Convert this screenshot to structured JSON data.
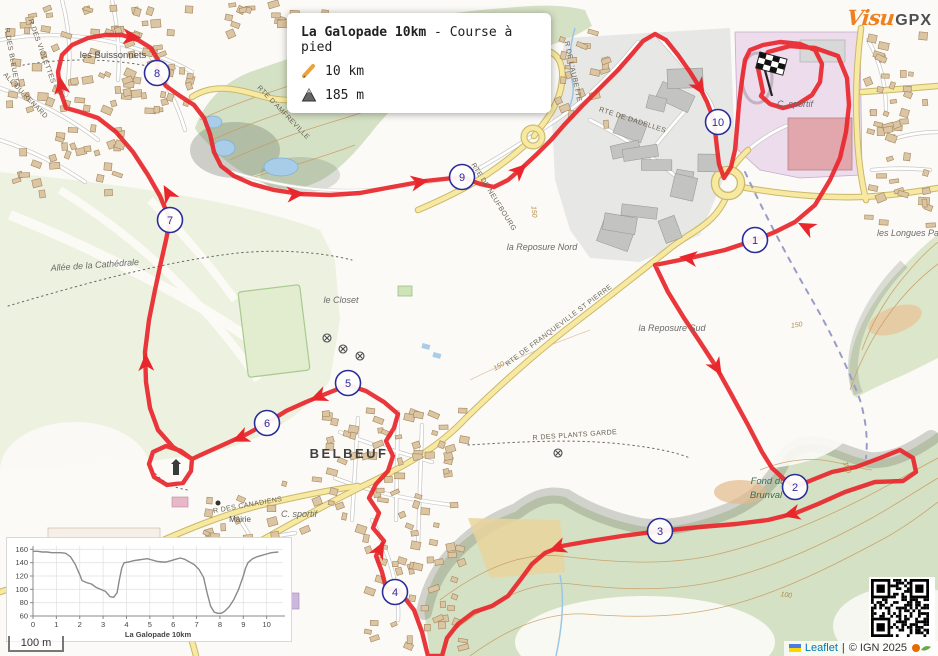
{
  "info_box": {
    "title_bold": "La Galopade 10km",
    "title_sep": " - ",
    "title_rest": "Course à pied",
    "distance": "10 km",
    "elevation_gain": "185 m"
  },
  "brand": {
    "visu": "Visu",
    "gpx": "GPX"
  },
  "scale_bar": {
    "label": "100 m"
  },
  "attribution": {
    "leaflet": "Leaflet",
    "separator": "|",
    "ign": "© IGN 2025"
  },
  "colors": {
    "route": "#e8262b",
    "marker_border": "#2d2d99",
    "forest": "#d5e1c4",
    "road_main": "#f8e9a2",
    "water": "#a8cde8",
    "brand_orange": "#f07f1e"
  },
  "map": {
    "km_markers": [
      {
        "label": "1",
        "x": 755,
        "y": 240
      },
      {
        "label": "2",
        "x": 795,
        "y": 487
      },
      {
        "label": "3",
        "x": 660,
        "y": 531
      },
      {
        "label": "4",
        "x": 395,
        "y": 592
      },
      {
        "label": "5",
        "x": 348,
        "y": 383
      },
      {
        "label": "6",
        "x": 267,
        "y": 423
      },
      {
        "label": "7",
        "x": 170,
        "y": 220
      },
      {
        "label": "8",
        "x": 157,
        "y": 73
      },
      {
        "label": "9",
        "x": 462,
        "y": 177
      },
      {
        "label": "10",
        "x": 718,
        "y": 122
      }
    ],
    "labels": [
      {
        "t": "les Buissonnets",
        "x": 113,
        "y": 58,
        "r": 0,
        "c": "place"
      },
      {
        "t": "BELBEUF",
        "x": 349,
        "y": 458,
        "r": 0,
        "c": "town"
      },
      {
        "t": "le Closet",
        "x": 341,
        "y": 303,
        "r": 0,
        "c": "place-i"
      },
      {
        "t": "la Reposure Nord",
        "x": 542,
        "y": 250,
        "r": 0,
        "c": "place-i"
      },
      {
        "t": "la Reposure Sud",
        "x": 672,
        "y": 331,
        "r": 0,
        "c": "place-i"
      },
      {
        "t": "Allée de la Cathédrale",
        "x": 95,
        "y": 268,
        "r": -4,
        "c": "place-i"
      },
      {
        "t": "les Longues Pa",
        "x": 908,
        "y": 236,
        "r": 0,
        "c": "place-i"
      },
      {
        "t": "Fond du",
        "x": 768,
        "y": 484,
        "r": 0,
        "c": "nature"
      },
      {
        "t": "Brunval",
        "x": 766,
        "y": 498,
        "r": 0,
        "c": "nature"
      },
      {
        "t": "C. sportif",
        "x": 795,
        "y": 107,
        "r": 0,
        "c": "place-i"
      },
      {
        "t": "C. sportif",
        "x": 299,
        "y": 517,
        "r": 0,
        "c": "place-i"
      },
      {
        "t": "Mairie",
        "x": 240,
        "y": 522,
        "r": 0,
        "c": "place-s"
      },
      {
        "t": "RTE DE FRANQUEVILLE ST PIERRE",
        "x": 560,
        "y": 327,
        "r": -37,
        "c": "road"
      },
      {
        "t": "RTE DE DADELLES",
        "x": 632,
        "y": 122,
        "r": 18,
        "c": "road"
      },
      {
        "t": "R DES CANADIENS",
        "x": 248,
        "y": 507,
        "r": -10,
        "c": "road"
      },
      {
        "t": "R DES PLANTS GARDE",
        "x": 575,
        "y": 437,
        "r": -4,
        "c": "road"
      },
      {
        "t": "RTE D'AMFREVILLE",
        "x": 282,
        "y": 114,
        "r": 46,
        "c": "road"
      },
      {
        "t": "RTE DE NEUFBOURG",
        "x": 492,
        "y": 198,
        "r": 58,
        "c": "road"
      },
      {
        "t": "R DES VIOLETTES",
        "x": 40,
        "y": 52,
        "r": 70,
        "c": "road"
      },
      {
        "t": "R DES BLEUETS",
        "x": 10,
        "y": 58,
        "r": 80,
        "c": "road"
      },
      {
        "t": "ALL DU RENARD",
        "x": 24,
        "y": 97,
        "r": 46,
        "c": "road"
      },
      {
        "t": "R DE L'AUBETTE",
        "x": 571,
        "y": 72,
        "r": 78,
        "c": "road"
      },
      {
        "t": "150",
        "x": 500,
        "y": 368,
        "r": -30,
        "c": "contour"
      },
      {
        "t": "150",
        "x": 532,
        "y": 212,
        "r": 85,
        "c": "contour"
      },
      {
        "t": "150",
        "x": 797,
        "y": 327,
        "r": -8,
        "c": "contour"
      },
      {
        "t": "100",
        "x": 845,
        "y": 468,
        "r": 70,
        "c": "contour"
      },
      {
        "t": "100",
        "x": 786,
        "y": 597,
        "r": 8,
        "c": "contour"
      }
    ],
    "route": {
      "color": "#e8262b",
      "points": [
        [
          763,
          92
        ],
        [
          758,
          68
        ],
        [
          768,
          52
        ],
        [
          790,
          46
        ],
        [
          815,
          48
        ],
        [
          838,
          56
        ],
        [
          847,
          78
        ],
        [
          849,
          105
        ],
        [
          846,
          132
        ],
        [
          840,
          158
        ],
        [
          830,
          180
        ],
        [
          815,
          205
        ],
        [
          795,
          222
        ],
        [
          775,
          232
        ],
        [
          755,
          240
        ],
        [
          725,
          250
        ],
        [
          690,
          258
        ],
        [
          655,
          265
        ],
        [
          668,
          292
        ],
        [
          684,
          318
        ],
        [
          700,
          342
        ],
        [
          715,
          365
        ],
        [
          730,
          392
        ],
        [
          748,
          425
        ],
        [
          762,
          452
        ],
        [
          772,
          468
        ],
        [
          785,
          480
        ],
        [
          795,
          487
        ],
        [
          812,
          480
        ],
        [
          832,
          472
        ],
        [
          856,
          467
        ],
        [
          880,
          458
        ],
        [
          900,
          450
        ],
        [
          913,
          458
        ],
        [
          916,
          472
        ],
        [
          903,
          481
        ],
        [
          875,
          482
        ],
        [
          845,
          492
        ],
        [
          818,
          504
        ],
        [
          796,
          513
        ],
        [
          768,
          520
        ],
        [
          736,
          524
        ],
        [
          700,
          527
        ],
        [
          660,
          531
        ],
        [
          622,
          536
        ],
        [
          590,
          541
        ],
        [
          562,
          546
        ],
        [
          545,
          553
        ],
        [
          532,
          564
        ],
        [
          521,
          579
        ],
        [
          508,
          596
        ],
        [
          492,
          606
        ],
        [
          474,
          612
        ],
        [
          458,
          624
        ],
        [
          447,
          638
        ],
        [
          442,
          656
        ],
        [
          428,
          656
        ],
        [
          422,
          632
        ],
        [
          414,
          610
        ],
        [
          404,
          597
        ],
        [
          398,
          590
        ],
        [
          386,
          588
        ],
        [
          382,
          572
        ],
        [
          376,
          556
        ],
        [
          384,
          541
        ],
        [
          373,
          528
        ],
        [
          379,
          513
        ],
        [
          369,
          498
        ],
        [
          376,
          484
        ],
        [
          388,
          471
        ],
        [
          393,
          456
        ],
        [
          386,
          441
        ],
        [
          394,
          428
        ],
        [
          398,
          414
        ],
        [
          384,
          402
        ],
        [
          366,
          391
        ],
        [
          348,
          385
        ],
        [
          328,
          393
        ],
        [
          306,
          402
        ],
        [
          286,
          411
        ],
        [
          267,
          423
        ],
        [
          247,
          434
        ],
        [
          225,
          444
        ],
        [
          205,
          453
        ],
        [
          192,
          459
        ],
        [
          181,
          451
        ],
        [
          166,
          446
        ],
        [
          153,
          452
        ],
        [
          149,
          464
        ],
        [
          154,
          477
        ],
        [
          167,
          485
        ],
        [
          183,
          483
        ],
        [
          191,
          471
        ],
        [
          192,
          459
        ],
        [
          173,
          447
        ],
        [
          158,
          430
        ],
        [
          150,
          408
        ],
        [
          146,
          382
        ],
        [
          145,
          352
        ],
        [
          149,
          320
        ],
        [
          155,
          290
        ],
        [
          161,
          262
        ],
        [
          166,
          240
        ],
        [
          170,
          220
        ],
        [
          160,
          196
        ],
        [
          148,
          175
        ],
        [
          133,
          152
        ],
        [
          116,
          132
        ],
        [
          98,
          118
        ],
        [
          80,
          112
        ],
        [
          66,
          108
        ],
        [
          60,
          90
        ],
        [
          58,
          72
        ],
        [
          62,
          55
        ],
        [
          72,
          45
        ],
        [
          88,
          38
        ],
        [
          105,
          35
        ],
        [
          122,
          35
        ],
        [
          138,
          40
        ],
        [
          151,
          48
        ],
        [
          158,
          60
        ],
        [
          157,
          73
        ],
        [
          166,
          86
        ],
        [
          180,
          96
        ],
        [
          194,
          105
        ],
        [
          204,
          118
        ],
        [
          210,
          134
        ],
        [
          214,
          152
        ],
        [
          221,
          166
        ],
        [
          234,
          176
        ],
        [
          252,
          184
        ],
        [
          274,
          190
        ],
        [
          300,
          194
        ],
        [
          330,
          195
        ],
        [
          360,
          193
        ],
        [
          392,
          187
        ],
        [
          425,
          181
        ],
        [
          462,
          177
        ],
        [
          480,
          184
        ],
        [
          494,
          187
        ],
        [
          508,
          180
        ],
        [
          522,
          168
        ],
        [
          537,
          154
        ],
        [
          551,
          140
        ],
        [
          565,
          124
        ],
        [
          582,
          106
        ],
        [
          600,
          88
        ],
        [
          618,
          70
        ],
        [
          632,
          54
        ],
        [
          643,
          41
        ],
        [
          655,
          34
        ],
        [
          666,
          40
        ],
        [
          678,
          55
        ],
        [
          690,
          72
        ],
        [
          700,
          88
        ],
        [
          707,
          102
        ],
        [
          712,
          115
        ],
        [
          715,
          130
        ],
        [
          717,
          148
        ],
        [
          719,
          164
        ],
        [
          724,
          178
        ],
        [
          731,
          167
        ],
        [
          735,
          150
        ],
        [
          737,
          128
        ],
        [
          739,
          104
        ],
        [
          742,
          80
        ],
        [
          745,
          60
        ],
        [
          750,
          50
        ],
        [
          763,
          45
        ],
        [
          780,
          42
        ],
        [
          800,
          44
        ],
        [
          815,
          50
        ],
        [
          822,
          64
        ],
        [
          820,
          82
        ],
        [
          812,
          95
        ],
        [
          798,
          104
        ],
        [
          783,
          108
        ],
        [
          770,
          104
        ],
        [
          761,
          96
        ],
        [
          763,
          92
        ]
      ],
      "arrows": [
        [
          806,
          227,
          207
        ],
        [
          688,
          258,
          187
        ],
        [
          717,
          368,
          59
        ],
        [
          557,
          548,
          160
        ],
        [
          791,
          514,
          166
        ],
        [
          240,
          438,
          156
        ],
        [
          318,
          397,
          158
        ],
        [
          380,
          549,
          298
        ],
        [
          132,
          37,
          5
        ],
        [
          61,
          85,
          262
        ],
        [
          146,
          362,
          268
        ],
        [
          420,
          182,
          350
        ],
        [
          296,
          194,
          356
        ],
        [
          700,
          88,
          58
        ],
        [
          520,
          170,
          317
        ],
        [
          168,
          193,
          241
        ]
      ]
    },
    "gates": [
      [
        327,
        338
      ],
      [
        343,
        349
      ],
      [
        360,
        356
      ],
      [
        558,
        453
      ]
    ],
    "flag": {
      "x": 760,
      "y": 52
    }
  },
  "chart_data": {
    "type": "line",
    "title": "",
    "xlabel": "La Galopade 10km",
    "ylabel": "",
    "xlim": [
      0,
      10.7
    ],
    "ylim": [
      60,
      165
    ],
    "xticks": [
      0,
      1,
      2,
      3,
      4,
      5,
      6,
      7,
      8,
      9,
      10
    ],
    "yticks": [
      60,
      80,
      100,
      120,
      140,
      160
    ],
    "grid": true,
    "line_color": "#8a8a8a",
    "series": [
      {
        "name": "elevation_m",
        "x": [
          0,
          0.2,
          0.4,
          0.6,
          0.8,
          1.0,
          1.2,
          1.4,
          1.6,
          1.8,
          2.0,
          2.1,
          2.3,
          2.5,
          2.7,
          2.9,
          3.1,
          3.2,
          3.3,
          3.45,
          3.6,
          3.7,
          3.8,
          3.9,
          4.1,
          4.3,
          4.5,
          4.7,
          4.9,
          5.1,
          5.3,
          5.5,
          5.7,
          5.9,
          6.1,
          6.3,
          6.5,
          6.7,
          6.9,
          7.1,
          7.3,
          7.45,
          7.6,
          7.75,
          7.9,
          8.05,
          8.2,
          8.4,
          8.6,
          8.8,
          9.0,
          9.1,
          9.2,
          9.4,
          9.6,
          9.8,
          10.0,
          10.2,
          10.5
        ],
        "y": [
          157,
          157,
          156,
          156,
          155,
          155,
          155,
          154,
          149,
          138,
          122,
          113,
          110,
          108,
          103,
          100,
          97,
          93,
          89,
          88,
          95,
          115,
          132,
          140,
          141,
          143,
          144,
          145,
          146,
          144,
          142,
          141,
          141,
          143,
          145,
          147,
          145,
          141,
          137,
          130,
          118,
          95,
          75,
          66,
          64,
          64,
          67,
          74,
          85,
          100,
          120,
          132,
          140,
          146,
          149,
          151,
          153,
          155,
          156
        ]
      }
    ]
  }
}
